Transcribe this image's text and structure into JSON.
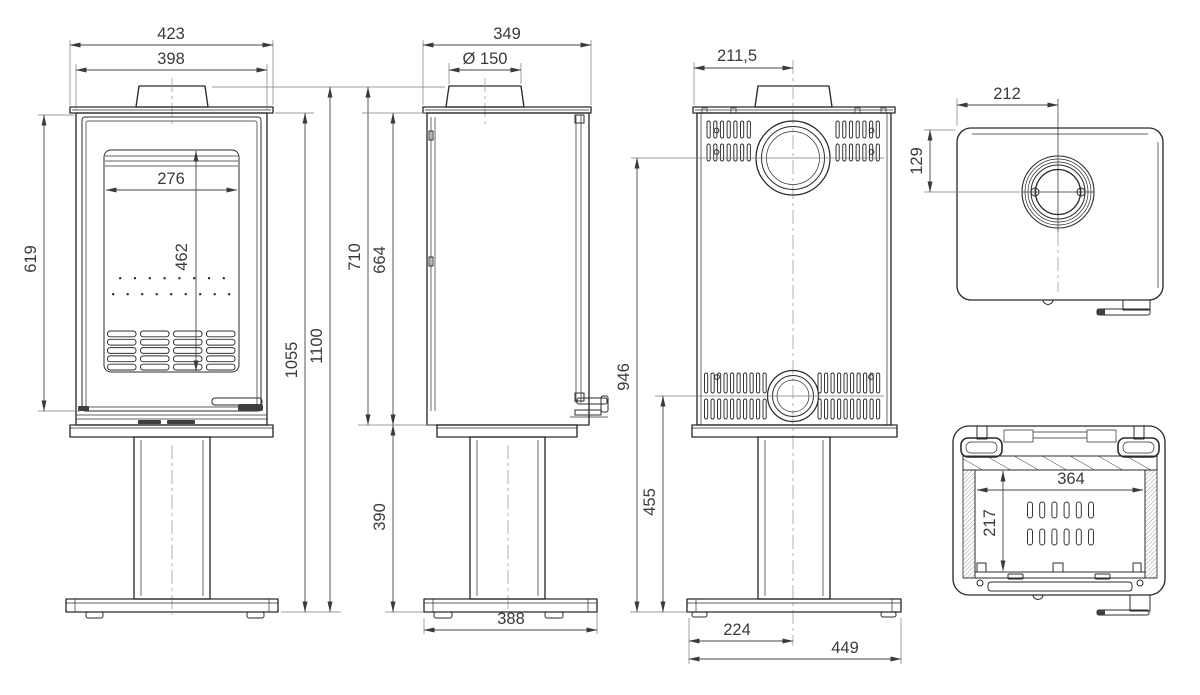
{
  "drawing": {
    "background": "#ffffff",
    "line_color": "#2b2b2b",
    "text_color": "#3a3a3a"
  },
  "dims": {
    "front": {
      "total_width": "423",
      "body_width": "398",
      "glass_width": "276",
      "glass_height": "462",
      "door_height": "619",
      "body_height": "1055",
      "total_height": "1100"
    },
    "side": {
      "depth": "349",
      "flue_diameter": "Ø 150",
      "top_height": "710",
      "body_top_height": "664",
      "pedestal_height": "390",
      "base_depth": "388"
    },
    "rear": {
      "flue_center_offset": "211,5",
      "flue_center_height": "946",
      "intake_center_height": "455",
      "base_center_offset": "224",
      "base_width": "449"
    },
    "top": {
      "flue_center_from_front": "212",
      "flue_center_from_rear": "129"
    },
    "firebox": {
      "width": "364",
      "depth": "217"
    }
  }
}
